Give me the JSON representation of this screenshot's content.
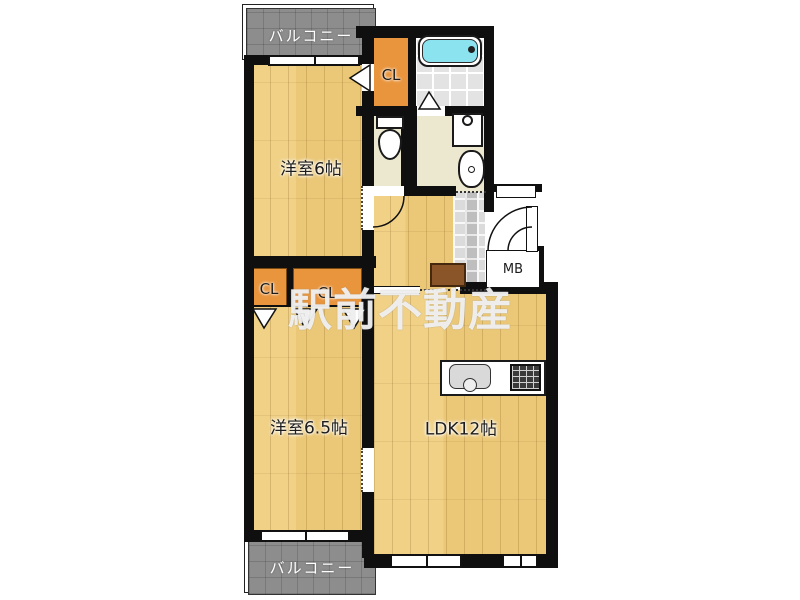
{
  "plan": {
    "balconies": {
      "top": "バルコニー",
      "bottom": "バルコニー"
    },
    "rooms": {
      "bedroom1": "洋室6帖",
      "bedroom2": "洋室6.5帖",
      "ldk": "LDK12帖"
    },
    "closets": {
      "top": "CL",
      "left": "CL",
      "middle": "CL"
    },
    "meter_box": "MB",
    "watermark": "駅前不動産",
    "colors": {
      "wood_floor": "#ebc877",
      "closet_fill": "#e9953e",
      "washroom_floor": "#ece8cf",
      "bath_tile": "#e3e3e3",
      "bathtub": "#8ae3ef",
      "balcony": "#8d8d8d",
      "wall": "#0f0f0f",
      "watermark_text": "#ffffff"
    }
  }
}
